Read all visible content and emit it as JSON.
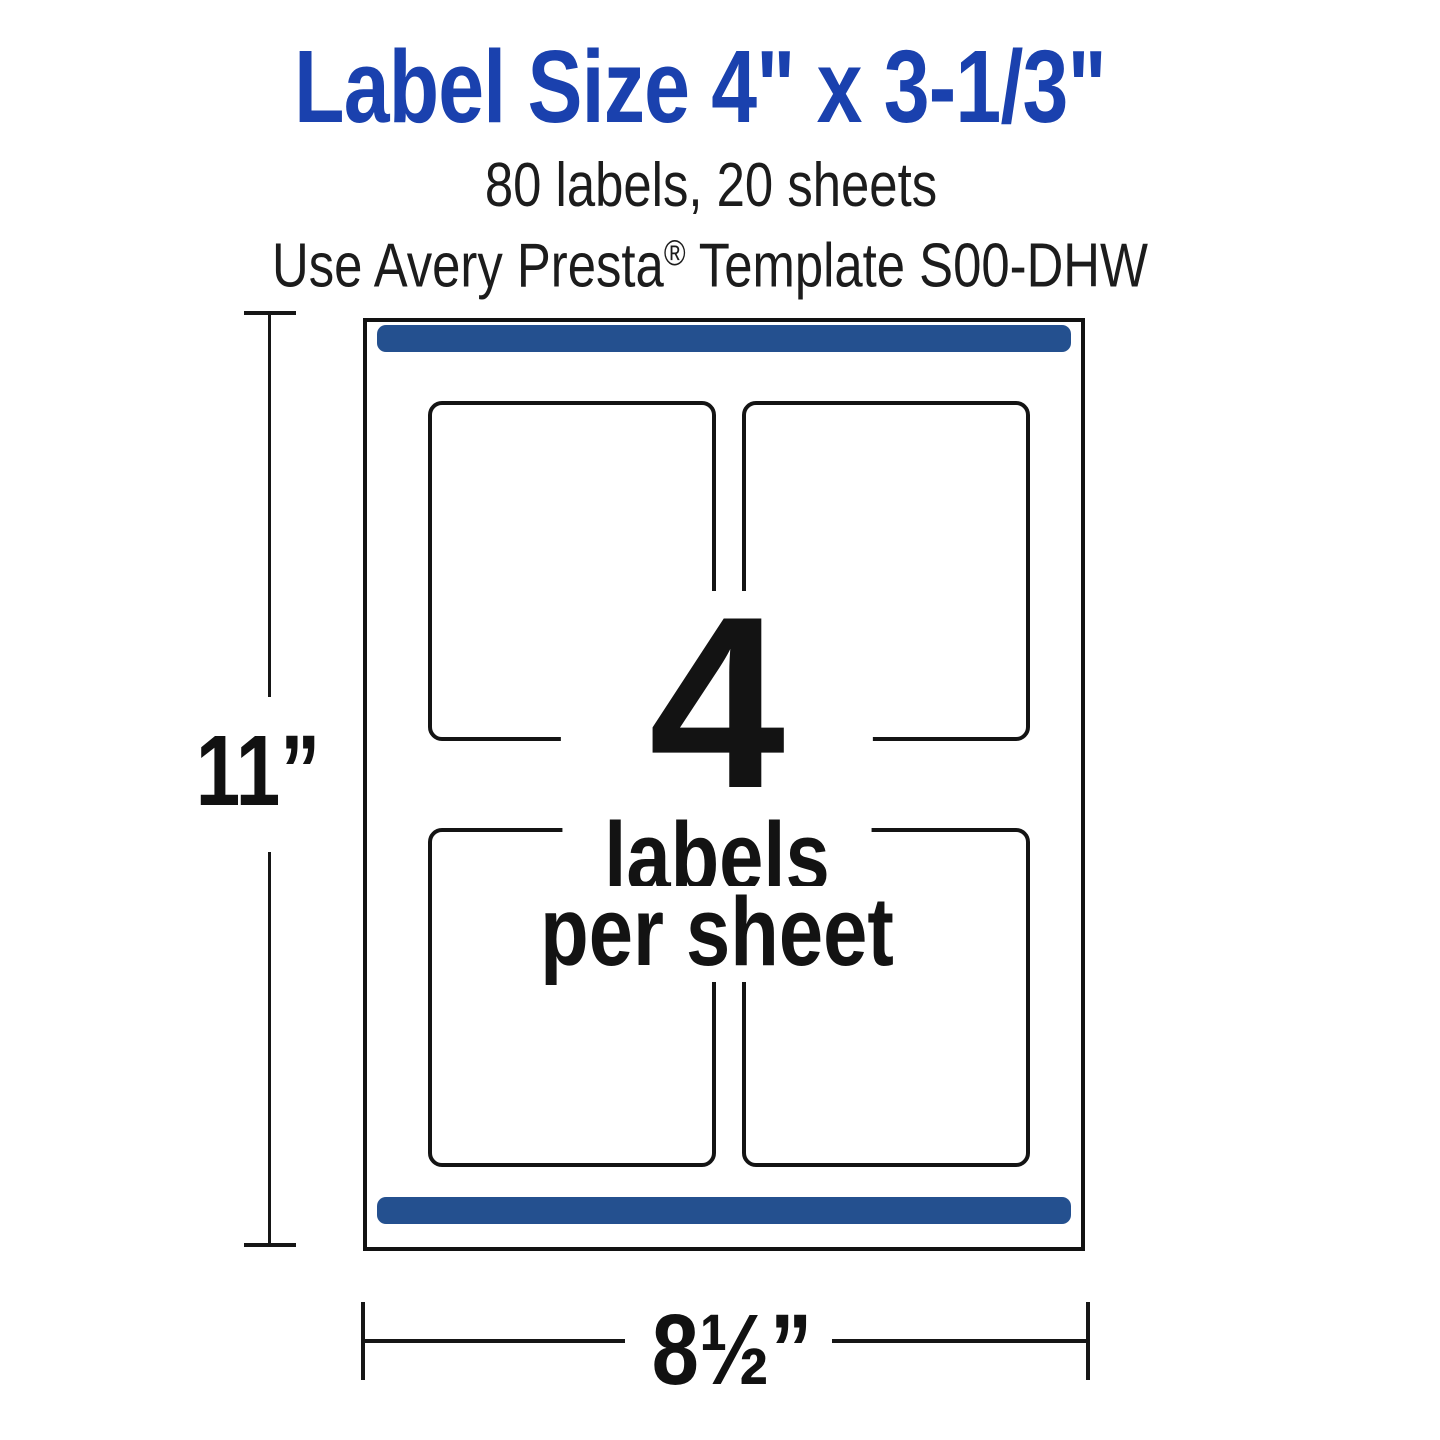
{
  "header": {
    "title": "Label Size 4\" x 3-1/3\"",
    "subtitle_line1": "80 labels, 20 sheets",
    "subtitle_line2_prefix": "Use Avery Presta",
    "subtitle_line2_reg": "®",
    "subtitle_line2_suffix": " Template S00-DHW"
  },
  "diagram": {
    "center_number": "4",
    "center_line1": "labels",
    "center_line2": "per sheet",
    "height_dimension": "11”",
    "width_dimension": "8½”",
    "labels_grid": {
      "rows": 2,
      "columns": 2
    },
    "colors": {
      "title_blue": "#1a41ae",
      "bar_navy": "#24508f",
      "ink": "#1d1d1b"
    }
  }
}
